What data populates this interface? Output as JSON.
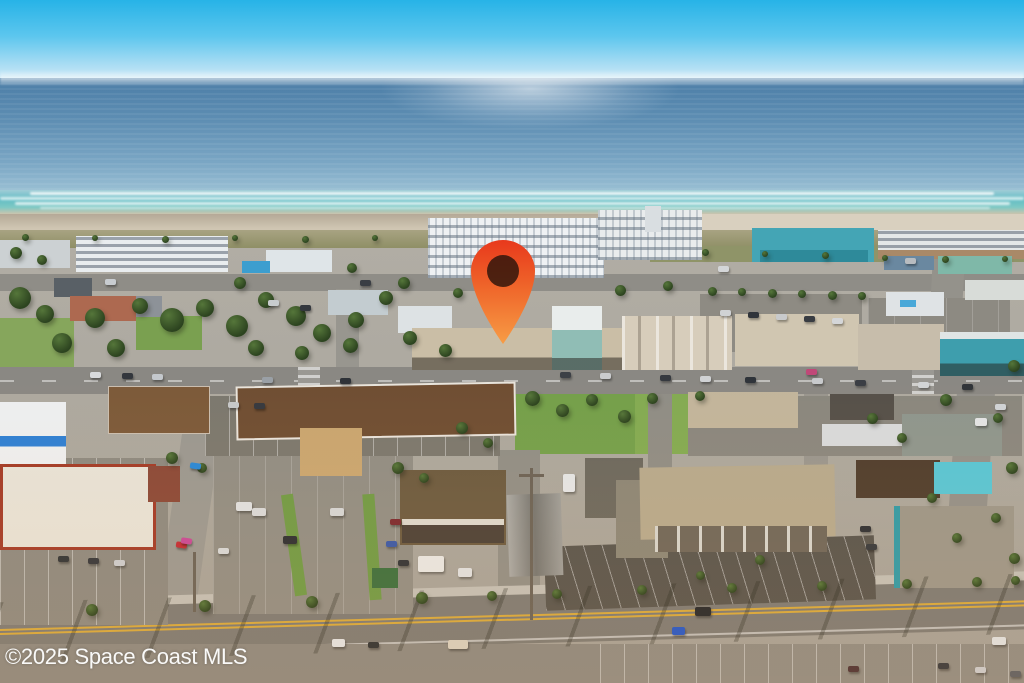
{
  "watermark": {
    "text": "©2025 Space Coast MLS",
    "color": "#ffffff"
  },
  "pin": {
    "name": "location-pin-icon",
    "color_top": "#e8391c",
    "color_mid": "#ef652a",
    "color_bottom": "#f79c45",
    "hole_color": "#2a140b",
    "x": 468,
    "y": 237,
    "width": 70,
    "height": 108
  },
  "palette": {
    "sky_top": "#27b3e7",
    "sky_horizon": "#cfeaf6",
    "ocean_deep": "#4c7ea7",
    "ocean_shore": "#abccd8",
    "surf": "#62bdc5",
    "sand": "#d5cbb8",
    "dune": "#8f8f66",
    "ground": "#aaa69d",
    "road": "#8a8883",
    "highway": "#7c7a75",
    "lawn": "#74a04b",
    "roof_white": "#eef1f3",
    "roof_teal": "#44a5b5",
    "roof_brown": "#6f4e33",
    "roof_tan": "#b6a98e"
  },
  "scene": {
    "rects": [
      [
        30,
        192,
        964,
        3,
        "rgba(255,255,255,0.85)",
        "foam"
      ],
      [
        0,
        197,
        1024,
        3,
        "rgba(255,255,255,0.7)",
        "foam"
      ],
      [
        15,
        202,
        995,
        3,
        "rgba(255,255,255,0.75)",
        "foam"
      ],
      [
        40,
        207,
        950,
        2,
        "rgba(255,255,255,0.6)",
        "foam"
      ],
      [
        515,
        390,
        120,
        64,
        "#74a04b",
        ""
      ],
      [
        635,
        394,
        118,
        60,
        "#83ab53",
        ""
      ],
      [
        0,
        318,
        74,
        50,
        "#86a65c",
        ""
      ],
      [
        136,
        316,
        66,
        34,
        "#7aa050",
        ""
      ],
      [
        0,
        554,
        48,
        72,
        "#6d9748",
        ""
      ],
      [
        0,
        626,
        96,
        57,
        "#87aa58",
        ""
      ],
      [
        560,
        585,
        464,
        14,
        "#7f9e50",
        "",
        -1
      ],
      [
        96,
        598,
        240,
        14,
        "#7f9e50",
        "",
        -2
      ],
      [
        0,
        274,
        1024,
        17,
        "#8f8d87",
        ""
      ],
      [
        930,
        248,
        32,
        128,
        "#94928b",
        "",
        3
      ],
      [
        336,
        289,
        23,
        84,
        "#98968f",
        ""
      ],
      [
        168,
        426,
        38,
        218,
        "#9a9892",
        "",
        8
      ],
      [
        498,
        450,
        42,
        172,
        "#908e87",
        ""
      ],
      [
        648,
        392,
        24,
        205,
        "#8f8d86",
        ""
      ],
      [
        804,
        390,
        24,
        88,
        "#99968f",
        ""
      ],
      [
        950,
        392,
        38,
        200,
        "#92908a",
        "",
        4
      ],
      [
        0,
        367,
        1024,
        27,
        "#8a8883",
        "road-main"
      ],
      [
        298,
        367,
        22,
        27,
        "#9a9893",
        "crosswalk"
      ],
      [
        912,
        367,
        22,
        27,
        "#9a9893",
        "crosswalk"
      ],
      [
        -12,
        585,
        1100,
        10,
        "#c2bfb7",
        "",
        -1.6
      ],
      [
        -12,
        594,
        1100,
        49,
        "#7c7a75",
        "highway",
        -1.6
      ],
      [
        0,
        644,
        1024,
        39,
        "#8b8881",
        ""
      ],
      [
        205,
        396,
        295,
        60,
        "#7b786f",
        "stalls"
      ],
      [
        0,
        458,
        168,
        167,
        "#8c8981",
        "stalls"
      ],
      [
        213,
        456,
        200,
        158,
        "#908d85",
        "stalls-faint"
      ],
      [
        585,
        458,
        58,
        60,
        "#6b685f",
        ""
      ],
      [
        688,
        396,
        334,
        60,
        "#8a877f",
        ""
      ],
      [
        700,
        294,
        162,
        58,
        "#8e8b83",
        ""
      ],
      [
        868,
        298,
        142,
        60,
        "#8d8a82",
        "stalls-faint"
      ],
      [
        545,
        541,
        330,
        64,
        "#57544e",
        "stalls-dark",
        -2
      ],
      [
        600,
        644,
        424,
        39,
        "#8e8b84",
        "stalls"
      ],
      [
        288,
        494,
        12,
        102,
        "#6f9a46",
        "",
        -8
      ],
      [
        366,
        494,
        12,
        106,
        "#6f9a46",
        "",
        -4
      ],
      [
        372,
        568,
        26,
        20,
        "#3a6e3e",
        ""
      ],
      [
        0,
        240,
        70,
        28,
        "#ccd1d3",
        ""
      ],
      [
        76,
        236,
        152,
        36,
        "#e9edef",
        "win-h"
      ],
      [
        266,
        250,
        66,
        22,
        "#dfe5e8",
        ""
      ],
      [
        242,
        261,
        28,
        12,
        "#3c9ecf",
        ""
      ],
      [
        428,
        218,
        176,
        60,
        "#eef1f3",
        "windows"
      ],
      [
        598,
        210,
        104,
        50,
        "#e9eced",
        "windows"
      ],
      [
        645,
        206,
        16,
        26,
        "#d9dee1",
        ""
      ],
      [
        752,
        228,
        122,
        34,
        "#44a5b5",
        ""
      ],
      [
        760,
        250,
        108,
        12,
        "#2e8a9a",
        ""
      ],
      [
        878,
        230,
        146,
        22,
        "#e4e8e8",
        "win-h"
      ],
      [
        878,
        250,
        146,
        9,
        "#a98968",
        ""
      ],
      [
        884,
        256,
        50,
        14,
        "#6a88a0",
        ""
      ],
      [
        938,
        256,
        74,
        18,
        "#7fb8a8",
        ""
      ],
      [
        886,
        292,
        58,
        24,
        "#dfe3e5",
        ""
      ],
      [
        900,
        300,
        16,
        7,
        "#49a8d8",
        ""
      ],
      [
        965,
        280,
        59,
        20,
        "#d8dcd8",
        ""
      ],
      [
        54,
        278,
        38,
        19,
        "#596066",
        ""
      ],
      [
        118,
        296,
        44,
        21,
        "#8d9298",
        ""
      ],
      [
        328,
        290,
        60,
        25,
        "#c3ccd0",
        ""
      ],
      [
        398,
        306,
        54,
        27,
        "#dde2e4",
        ""
      ],
      [
        70,
        296,
        66,
        25,
        "#ad6950",
        ""
      ],
      [
        412,
        328,
        210,
        42,
        "#cabea6",
        "storefront"
      ],
      [
        552,
        306,
        50,
        26,
        "#e9edec",
        ""
      ],
      [
        552,
        330,
        50,
        40,
        "#90bdb5",
        "storefront"
      ],
      [
        622,
        316,
        110,
        54,
        "#d7cdbb",
        "gables"
      ],
      [
        735,
        314,
        124,
        52,
        "#d0c6b1",
        ""
      ],
      [
        858,
        324,
        86,
        46,
        "#c7bdab",
        ""
      ],
      [
        940,
        334,
        86,
        42,
        "#3e9ead",
        "storefront"
      ],
      [
        940,
        332,
        86,
        7,
        "#dfe5e5",
        ""
      ],
      [
        688,
        392,
        110,
        36,
        "#c2b59c",
        ""
      ],
      [
        830,
        394,
        64,
        26,
        "#55504a",
        ""
      ],
      [
        822,
        424,
        82,
        22,
        "#d8dadc",
        ""
      ],
      [
        902,
        414,
        100,
        42,
        "#8e968e",
        ""
      ],
      [
        108,
        386,
        100,
        46,
        "#7c5a3a",
        "ridge2"
      ],
      [
        236,
        384,
        276,
        50,
        "#6f4e33",
        "ridge",
        -1
      ],
      [
        300,
        428,
        62,
        48,
        "#c9a671",
        ""
      ],
      [
        0,
        402,
        66,
        62,
        "#edeff1",
        "bluestripe"
      ],
      [
        0,
        464,
        150,
        80,
        "#e7e3d9",
        "redtrim"
      ],
      [
        148,
        466,
        32,
        36,
        "#8a4838",
        ""
      ],
      [
        400,
        470,
        106,
        75,
        "#6b5a40",
        ""
      ],
      [
        402,
        519,
        102,
        6,
        "#efeee9",
        "",
        0,
        0.85
      ],
      [
        402,
        525,
        102,
        18,
        "#4a4038",
        ""
      ],
      [
        508,
        494,
        54,
        82,
        "#8d8d89",
        "gable-v",
        -2
      ],
      [
        616,
        480,
        52,
        78,
        "#8b8678",
        ""
      ],
      [
        640,
        466,
        195,
        72,
        "#b6a98e",
        "",
        -1
      ],
      [
        655,
        526,
        172,
        26,
        "#6e665a",
        "cols"
      ],
      [
        856,
        460,
        84,
        38,
        "#4e3d2e",
        ""
      ],
      [
        934,
        462,
        58,
        32,
        "#57c6d6",
        ""
      ],
      [
        894,
        506,
        114,
        82,
        "#9b968a",
        "teal-edge"
      ],
      [
        530,
        468,
        3,
        152,
        "#6a6257",
        ""
      ],
      [
        519,
        474,
        25,
        3,
        "#6a6257",
        ""
      ],
      [
        193,
        552,
        3,
        60,
        "#6a6257",
        ""
      ],
      [
        0,
        588,
        1024,
        60,
        "",
        "palm-shadows",
        -1.6
      ]
    ],
    "trees": [
      [
        20,
        298,
        22
      ],
      [
        45,
        314,
        18
      ],
      [
        95,
        318,
        20
      ],
      [
        140,
        306,
        16
      ],
      [
        172,
        320,
        24
      ],
      [
        205,
        308,
        18
      ],
      [
        237,
        326,
        22
      ],
      [
        266,
        300,
        16
      ],
      [
        296,
        316,
        20
      ],
      [
        322,
        333,
        18
      ],
      [
        356,
        320,
        16
      ],
      [
        386,
        298,
        14
      ],
      [
        62,
        343,
        20
      ],
      [
        116,
        348,
        18
      ],
      [
        256,
        348,
        16
      ],
      [
        302,
        353,
        14
      ],
      [
        350,
        345,
        15
      ],
      [
        410,
        338,
        14
      ],
      [
        445,
        350,
        13
      ],
      [
        16,
        253,
        12
      ],
      [
        42,
        260,
        10
      ],
      [
        240,
        283,
        12
      ],
      [
        352,
        268,
        10
      ],
      [
        404,
        283,
        12
      ],
      [
        458,
        293,
        10
      ],
      [
        620,
        290,
        11
      ],
      [
        668,
        286,
        10
      ],
      [
        25,
        237,
        7
      ],
      [
        95,
        238,
        6
      ],
      [
        165,
        239,
        7
      ],
      [
        235,
        238,
        6
      ],
      [
        305,
        239,
        7
      ],
      [
        375,
        238,
        6
      ],
      [
        705,
        252,
        7
      ],
      [
        765,
        254,
        6
      ],
      [
        825,
        255,
        7
      ],
      [
        885,
        258,
        6
      ],
      [
        945,
        259,
        7
      ],
      [
        1005,
        259,
        6
      ],
      [
        712,
        291,
        9
      ],
      [
        742,
        292,
        8
      ],
      [
        772,
        293,
        9
      ],
      [
        802,
        294,
        8
      ],
      [
        832,
        295,
        9
      ],
      [
        862,
        296,
        8
      ],
      [
        532,
        398,
        15
      ],
      [
        562,
        410,
        13
      ],
      [
        592,
        400,
        12
      ],
      [
        624,
        416,
        13
      ],
      [
        652,
        398,
        11
      ],
      [
        700,
        396,
        10
      ],
      [
        1014,
        366,
        12
      ],
      [
        998,
        418,
        10
      ],
      [
        1012,
        468,
        12
      ],
      [
        996,
        518,
        10
      ],
      [
        1014,
        558,
        11
      ],
      [
        462,
        428,
        12
      ],
      [
        488,
        443,
        10
      ],
      [
        172,
        458,
        12
      ],
      [
        202,
        468,
        10
      ],
      [
        398,
        468,
        12
      ],
      [
        424,
        478,
        10
      ],
      [
        872,
        418,
        11
      ],
      [
        946,
        400,
        12
      ],
      [
        902,
        438,
        10
      ],
      [
        932,
        498,
        10
      ],
      [
        957,
        538,
        10
      ],
      [
        760,
        560,
        10
      ],
      [
        700,
        575,
        9
      ],
      [
        92,
        610,
        12
      ],
      [
        205,
        606,
        12
      ],
      [
        312,
        602,
        12
      ],
      [
        422,
        598,
        12
      ],
      [
        492,
        596,
        10
      ],
      [
        557,
        594,
        10
      ],
      [
        642,
        590,
        10
      ],
      [
        732,
        588,
        10
      ],
      [
        822,
        586,
        10
      ],
      [
        907,
        584,
        10
      ],
      [
        977,
        582,
        10
      ],
      [
        1015,
        580,
        9
      ]
    ],
    "cars": [
      [
        90,
        372,
        "#d8dadc"
      ],
      [
        122,
        373,
        "#33373d"
      ],
      [
        152,
        374,
        "#c4c8cc"
      ],
      [
        262,
        377,
        "#9aa0a6"
      ],
      [
        340,
        378,
        "#2e3238"
      ],
      [
        560,
        372,
        "#3c4046"
      ],
      [
        600,
        373,
        "#caccce"
      ],
      [
        660,
        375,
        "#35393f"
      ],
      [
        700,
        376,
        "#d0d2d4"
      ],
      [
        745,
        377,
        "#2f343a"
      ],
      [
        812,
        378,
        "#c8cacc"
      ],
      [
        855,
        380,
        "#3a3e44"
      ],
      [
        918,
        382,
        "#d2d4d6"
      ],
      [
        962,
        384,
        "#303439"
      ],
      [
        105,
        279,
        "#c8ccd0"
      ],
      [
        360,
        280,
        "#3a3e44"
      ],
      [
        718,
        266,
        "#d4d6d8"
      ],
      [
        905,
        258,
        "#b8bcc0"
      ],
      [
        720,
        310,
        "#d0d2d4"
      ],
      [
        748,
        312,
        "#30343a"
      ],
      [
        776,
        314,
        "#c8cacc"
      ],
      [
        804,
        316,
        "#383c42"
      ],
      [
        832,
        318,
        "#d4d6d8"
      ],
      [
        300,
        305,
        "#34383e"
      ],
      [
        268,
        300,
        "#c8ccce"
      ],
      [
        806,
        369,
        "#c04878"
      ],
      [
        228,
        402,
        "#c6c8ca"
      ],
      [
        254,
        403,
        "#36393f"
      ],
      [
        58,
        556,
        "#2f3338"
      ],
      [
        88,
        558,
        "#33363c"
      ],
      [
        114,
        560,
        "#caccd0"
      ],
      [
        218,
        548,
        "#d6d8da"
      ],
      [
        176,
        542,
        "#c22b35",
        8
      ],
      [
        190,
        463,
        "#2888d8",
        8
      ],
      [
        181,
        538,
        "#c84898",
        8
      ],
      [
        236,
        502,
        "#dfe1e3",
        0,
        16,
        9
      ],
      [
        252,
        508,
        "#d8dadc",
        0,
        14,
        8
      ],
      [
        330,
        508,
        "#d4d6d8",
        0,
        14,
        8
      ],
      [
        283,
        536,
        "#2b2e33",
        0,
        14,
        8
      ],
      [
        390,
        519,
        "#7a2830"
      ],
      [
        386,
        541,
        "#3858a8"
      ],
      [
        398,
        560,
        "#2e3238"
      ],
      [
        860,
        526,
        "#2c2f35"
      ],
      [
        866,
        544,
        "#34383e"
      ],
      [
        975,
        418,
        "#e2e4e6",
        0,
        12,
        8
      ],
      [
        995,
        404,
        "#cfd3d6"
      ],
      [
        418,
        556,
        "#e8e8e6",
        0,
        26,
        16
      ],
      [
        458,
        568,
        "#dfe1e3",
        0,
        14,
        9
      ],
      [
        563,
        474,
        "#e4e6e8",
        0,
        12,
        18
      ],
      [
        695,
        607,
        "#23262b",
        0,
        16,
        9
      ],
      [
        672,
        627,
        "#2356c8",
        0,
        13,
        8
      ],
      [
        848,
        666,
        "#4a3034"
      ],
      [
        992,
        637,
        "#dfe2e4",
        0,
        14,
        8
      ],
      [
        332,
        639,
        "#e2e4e6",
        0,
        13,
        8
      ],
      [
        368,
        642,
        "#2c3034"
      ],
      [
        448,
        640,
        "#d8d0c0",
        0,
        20,
        9
      ],
      [
        938,
        663,
        "#33373d"
      ],
      [
        975,
        667,
        "#caccd0"
      ],
      [
        1010,
        671,
        "#5a5e64"
      ]
    ]
  }
}
